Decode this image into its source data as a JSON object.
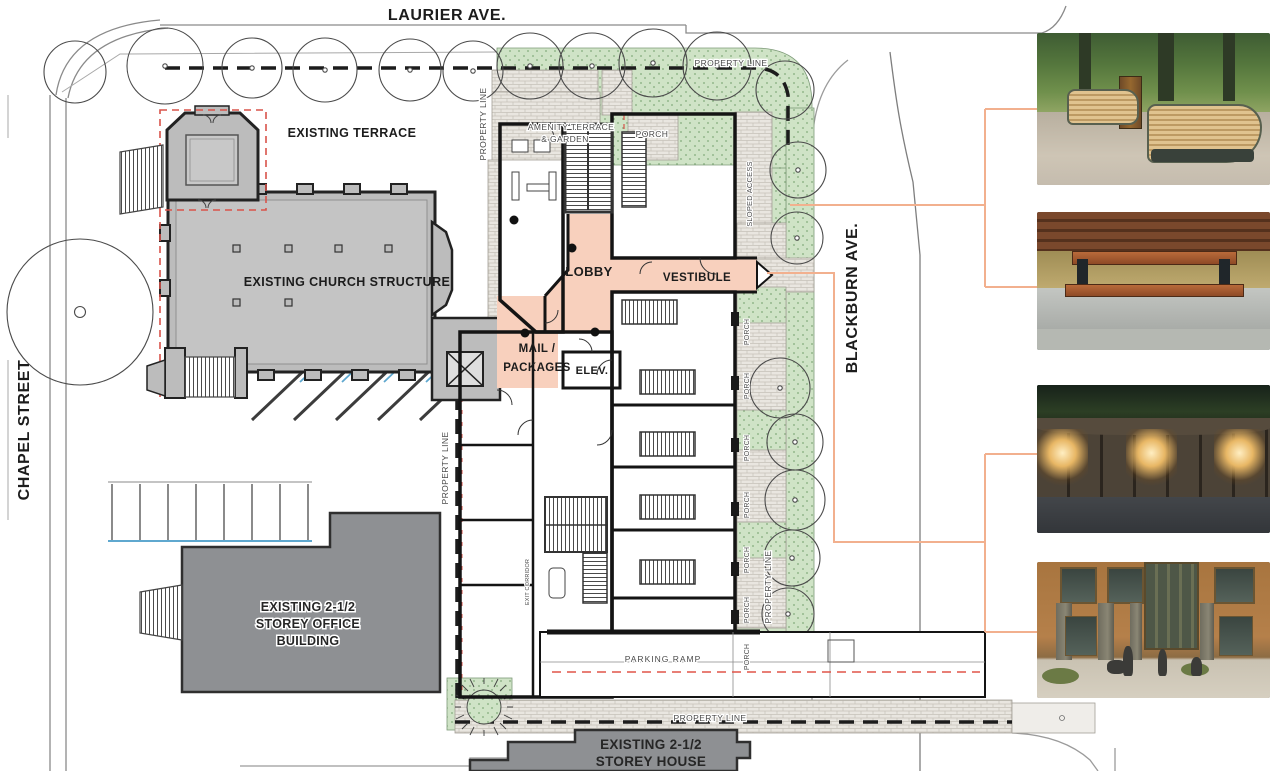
{
  "streets": {
    "laurier": "LAURIER AVE.",
    "chapel": "CHAPEL STREET",
    "blackburn": "BLACKBURN AVE."
  },
  "labels": {
    "property_line": "PROPERTY LINE",
    "porch": "PORCH",
    "sloped_access": "SLOPED ACCESS",
    "exit_corridor": "EXIT CORRIDOR",
    "parking_ramp": "PARKING RAMP",
    "existing_terrace": "EXISTING TERRACE",
    "existing_church": "EXISTING CHURCH STRUCTURE",
    "lobby": "LOBBY",
    "vestibule": "VESTIBULE",
    "mail_line1": "MAIL /",
    "mail_line2": "PACKAGES",
    "elevator": "ELEV.",
    "amenity_line1": "AMENITY TERRACE",
    "amenity_line2": "& GARDEN"
  },
  "office_building": {
    "line1": "EXISTING 2-1/2",
    "line2": "STOREY OFFICE",
    "line3": "BUILDING"
  },
  "house": {
    "line1": "EXISTING 2-1/2",
    "line2": "STOREY HOUSE"
  },
  "photos": [
    {
      "name": "curved-wood-park-benches",
      "title": "Curved wood park benches on paved walkway"
    },
    {
      "name": "wood-bench-concrete-planter",
      "title": "Wood bench set into concrete planter curb"
    },
    {
      "name": "stone-wall-lighting",
      "title": "Stone retaining wall with accent night lighting"
    },
    {
      "name": "residential-entrance-rendering",
      "title": "Brick residential building entrance rendering"
    }
  ],
  "colors": {
    "landscape_green": "#cfe3c6",
    "plan_pink": "#f8d0bd",
    "church_gray": "#bcbcbc",
    "building_dark_gray": "#8e9093",
    "connector_orange": "#f2b08e",
    "red_dashed": "#d9534a",
    "parking_blue": "#5fa8cf"
  }
}
